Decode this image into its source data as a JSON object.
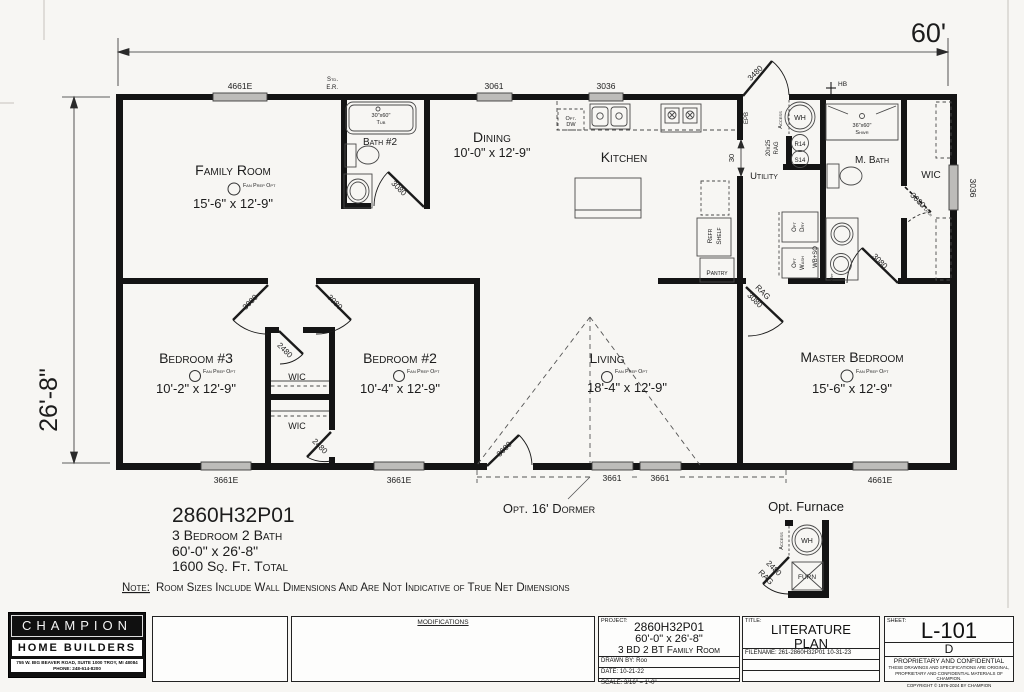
{
  "dimensions": {
    "overall_width": "60'",
    "overall_height": "26'-8\"",
    "kitchen_pass": "30"
  },
  "windows": {
    "family_top": "4661E",
    "dining_top": "3061",
    "kitchen_top": "3036",
    "bed3_bottom": "3661E",
    "bed2_bottom": "3661E",
    "dormer_left": "3661",
    "dormer_right": "3661",
    "master_bottom": "4661E",
    "wic_side": "3036"
  },
  "doors": {
    "entry_rear": "3480",
    "bath2": "3080",
    "bed3": "3080",
    "bed2": "3080",
    "wic_hall": "2480",
    "wic_bed2": "2480",
    "front": "3680",
    "master_rag": "RAG",
    "master": "3080",
    "mbath": "3080",
    "wic_opt": "3080",
    "wic_opt_note": "Opt Door",
    "furnace_door": "2480",
    "furnace_door_rag": "RAG"
  },
  "rooms": {
    "family": {
      "name": "Family Room",
      "size": "15'-6\" x 12'-9\""
    },
    "bath2": {
      "name": "Bath #2",
      "tub_size": "30\"x60\"",
      "tub": "Tub"
    },
    "dining": {
      "name": "Dining",
      "size": "10'-0\" x 12'-9\""
    },
    "kitchen": {
      "name": "Kitchen",
      "opt_dw_1": "Opt.",
      "opt_dw_2": "DW",
      "pantry": "Pantry",
      "refr": "Refr",
      "shelf": "Shelf",
      "epb": "EPB"
    },
    "utility": {
      "name": "Utility",
      "access": "Access",
      "wh": "WH",
      "r14": "R14",
      "s14": "S14",
      "rag_size": "20x25",
      "rag": "RAG",
      "dry_1": "Opt",
      "dry_2": "Dry",
      "wash_1": "Opt",
      "wash_2": "Wash",
      "wbso": "WB+SO",
      "hb": "HB"
    },
    "mbath": {
      "name": "M. Bath",
      "shower_size": "36\"x60\"",
      "shower": "Shwr",
      "opt": "Opt"
    },
    "wic_master": {
      "name": "WIC"
    },
    "bed3": {
      "name": "Bedroom #3",
      "size": "10'-2\" x 12'-9\""
    },
    "bed2": {
      "name": "Bedroom #2",
      "size": "10'-4\" x 12'-9\""
    },
    "wic1": {
      "name": "WIC"
    },
    "wic2": {
      "name": "WIC"
    },
    "living": {
      "name": "Living",
      "size": "18'-4\" x 12'-9\""
    },
    "master": {
      "name": "Master Bedroom",
      "size": "15'-6\" x 12'-9\""
    }
  },
  "fan_note": "Fan Prep Opt",
  "std_er_1": "Std.",
  "std_er_2": "E.R.",
  "annotations": {
    "model": "2860H32P01",
    "beds": "3 Bedroom 2 Bath",
    "size": "60'-0\" x 26'-8\"",
    "sqft": "1600 Sq. Ft. Total",
    "note_label": "Note:",
    "note": "Room Sizes Include Wall Dimensions And Are Not Indicative of True Net Dimensions",
    "dormer": "Opt. 16' Dormer",
    "furnace": "Opt. Furnace",
    "furn": "FURN"
  },
  "titleblock": {
    "logo": {
      "line1": "CHAMPION",
      "line2": "HOME BUILDERS",
      "address": "755 W. BIG BEAVER ROAD, SUITE 1000 TROY, MI 48084",
      "phone": "PHONE: 248-614-8200"
    },
    "modifications": "MODIFICATIONS",
    "project": {
      "label": "PROJECT:",
      "model": "2860H32P01",
      "size": "60'-0\" x 26'-8\"",
      "desc": "3 BD 2 BT Family Room",
      "drawn_by": "DRAWN BY: Roo",
      "date": "DATE: 10-21-22",
      "scale": "SCALE: 3/16\" = 1'-0\""
    },
    "title": {
      "label": "TITLE:",
      "line1": "LITERATURE",
      "line2": "PLAN",
      "filename": "FILENAME: 261-2860H32P01 10-31-23"
    },
    "sheet": {
      "label": "SHEET:",
      "number": "L-101",
      "revision": "D",
      "confidential": "PROPRIETARY AND CONFIDENTIAL",
      "fine1": "THESE DRAWINGS AND SPECIFICATIONS ARE ORIGINAL,",
      "fine2": "PROPRIETARY AND CONFIDENTIAL MATERIALS OF CHAMPION.",
      "copyright": "COPYRIGHT © 1976-2024 BY CHAMPION"
    }
  }
}
